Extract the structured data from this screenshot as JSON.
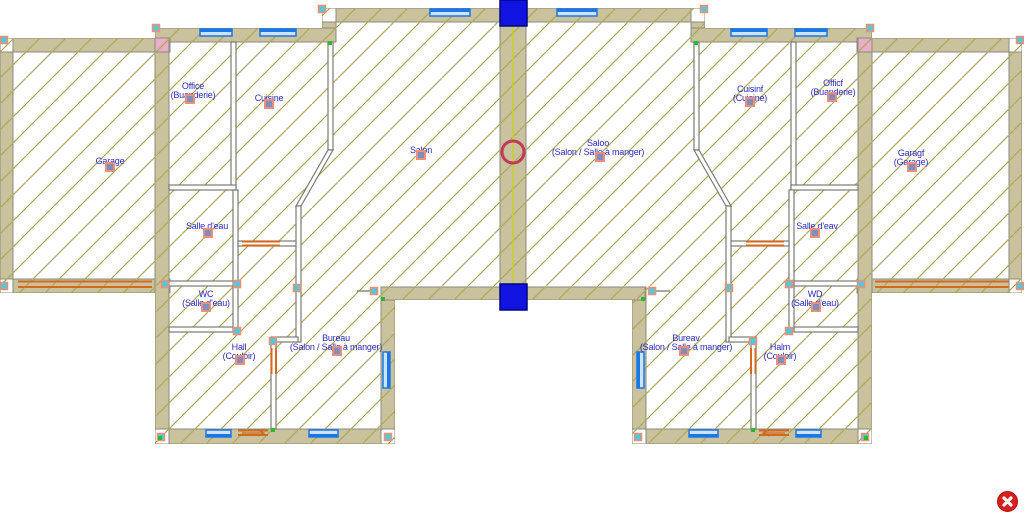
{
  "app": {
    "view": "floor-plan-canvas"
  },
  "colors": {
    "wall_fill": "#C9C29C",
    "wall_border": "#8A8A80",
    "hatch_line": "#ABA95C",
    "label_text": "#2B2BB4",
    "marker_fill": "#7F8FBC",
    "marker_border": "#EE8F7E",
    "handle_fill": "#58C6DA",
    "handle_border": "#EF8F70",
    "junction_dot": "#2ABB2A",
    "window_blue": "#1B76E8",
    "window_light": "#CFE3F7",
    "door_orange": "#D2691E",
    "mirror_axis_yellow": "#C9CE2E",
    "selection_square_blue": "#1113E0",
    "rotation_circle_red": "#C23A5A",
    "column_pink": "#E9AFC6",
    "close_button_red": "#D62020",
    "close_button_x": "#FFFFFF"
  },
  "rooms": [
    {
      "id": "garage-left",
      "lines": [
        "Garage"
      ],
      "x": 110,
      "y": 157,
      "marker": {
        "x": 110,
        "y": 167
      }
    },
    {
      "id": "office-left",
      "lines": [
        "Office",
        "(Buanderie)"
      ],
      "x": 193,
      "y": 82,
      "marker": {
        "x": 190,
        "y": 99
      }
    },
    {
      "id": "cuisine-left",
      "lines": [
        "Cuisine"
      ],
      "x": 269,
      "y": 94,
      "marker": {
        "x": 269,
        "y": 104
      }
    },
    {
      "id": "salon-left",
      "lines": [
        "Salon"
      ],
      "x": 421,
      "y": 146,
      "marker": {
        "x": 421,
        "y": 155
      }
    },
    {
      "id": "salle-eau-left",
      "lines": [
        "Salle d'eau"
      ],
      "x": 207,
      "y": 222,
      "marker": {
        "x": 208,
        "y": 233
      }
    },
    {
      "id": "wc-left",
      "lines": [
        "WC",
        "(Salle d'eau)"
      ],
      "x": 206,
      "y": 290,
      "marker": {
        "x": 206,
        "y": 307
      }
    },
    {
      "id": "hall-left",
      "lines": [
        "Hall",
        "(Couloir)"
      ],
      "x": 239,
      "y": 343,
      "marker": {
        "x": 240,
        "y": 360
      }
    },
    {
      "id": "bureau-left",
      "lines": [
        "Bureau",
        "(Salon / Salle à manger)"
      ],
      "x": 336,
      "y": 334,
      "marker": {
        "x": 337,
        "y": 351
      }
    },
    {
      "id": "salon-right",
      "lines": [
        "Saloo",
        "(Salon / Salle à manger)"
      ],
      "x": 598,
      "y": 139,
      "marker": {
        "x": 600,
        "y": 157
      }
    },
    {
      "id": "cuisine-right",
      "lines": [
        "Cuisinf",
        "(Cuisine)"
      ],
      "x": 750,
      "y": 85,
      "marker": {
        "x": 750,
        "y": 102
      }
    },
    {
      "id": "office-right",
      "lines": [
        "Officf",
        "(Buanderie)"
      ],
      "x": 833,
      "y": 79,
      "marker": {
        "x": 832,
        "y": 97
      }
    },
    {
      "id": "garage-right",
      "lines": [
        "Garagf",
        "(Garage)"
      ],
      "x": 911,
      "y": 149,
      "marker": {
        "x": 912,
        "y": 167
      }
    },
    {
      "id": "salle-eau-right",
      "lines": [
        "Salle d'eav"
      ],
      "x": 817,
      "y": 222,
      "marker": {
        "x": 815,
        "y": 233
      }
    },
    {
      "id": "wd-right",
      "lines": [
        "WD",
        "(Salle d'eau)"
      ],
      "x": 815,
      "y": 290,
      "marker": {
        "x": 816,
        "y": 307
      }
    },
    {
      "id": "hall-right",
      "lines": [
        "Halm",
        "(Couloir)"
      ],
      "x": 780,
      "y": 343,
      "marker": {
        "x": 781,
        "y": 360
      }
    },
    {
      "id": "bureau-right",
      "lines": [
        "Bureav",
        "(Salon / Salle à manger)"
      ],
      "x": 686,
      "y": 334,
      "marker": {
        "x": 684,
        "y": 351
      }
    }
  ],
  "close_button": {
    "action": "close"
  }
}
